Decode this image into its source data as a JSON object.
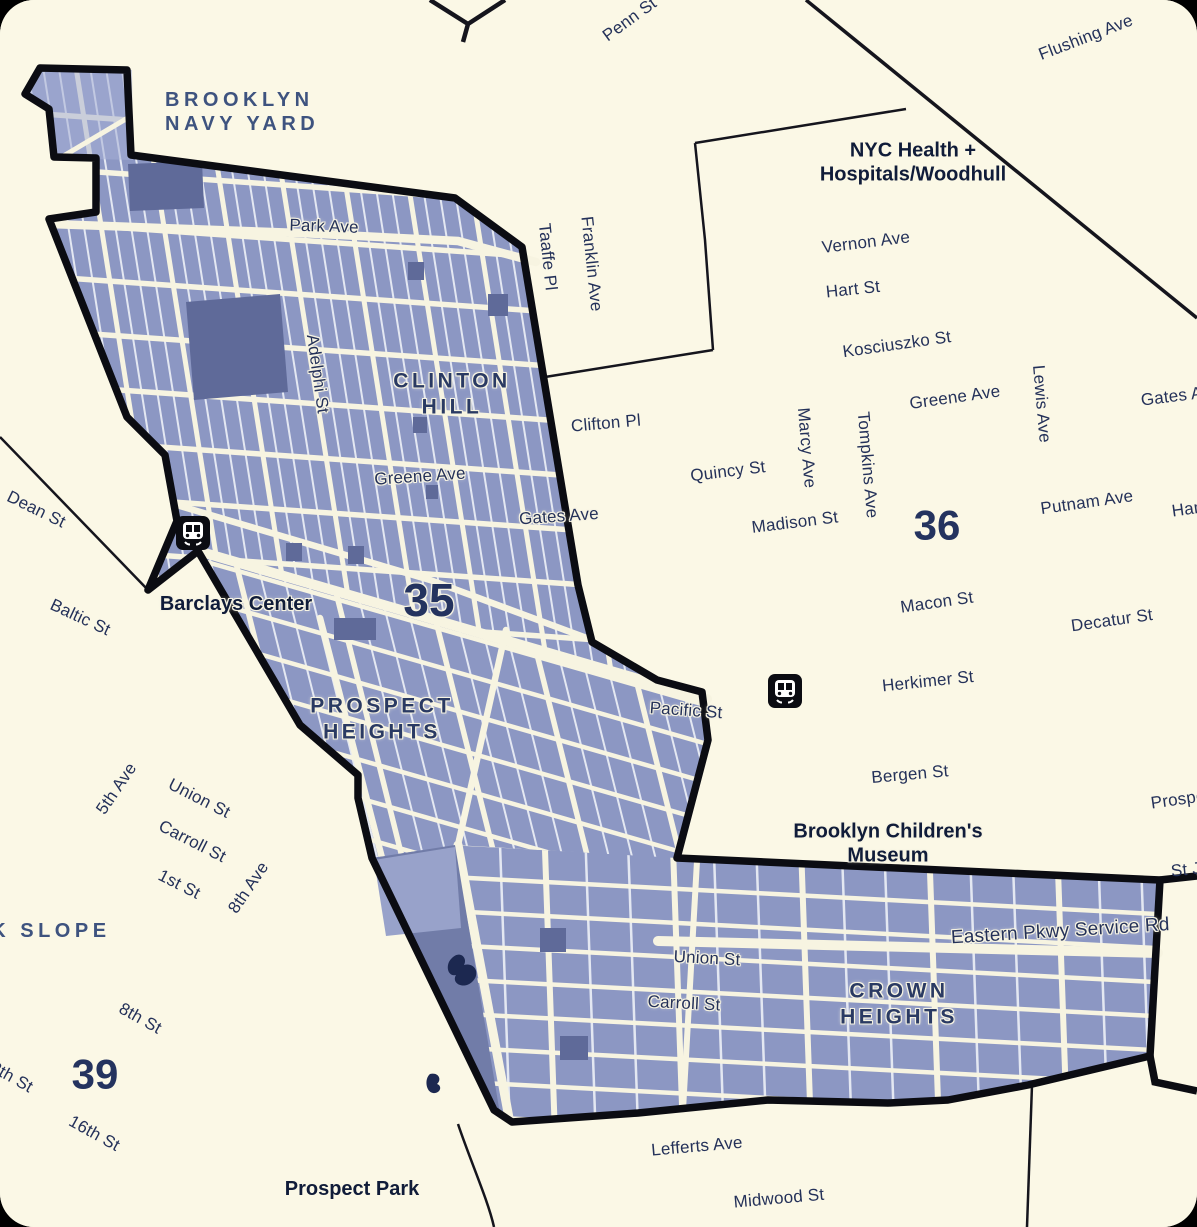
{
  "map": {
    "district_numbers": {
      "d35": "35",
      "d36": "36",
      "d39": "39"
    },
    "neighborhoods": {
      "brooklyn_navy_yard": "BROOKLYN\nNAVY YARD",
      "clinton_hill": "CLINTON\nHILL",
      "prospect_heights": "PROSPECT\nHEIGHTS",
      "crown_heights": "CROWN\nHEIGHTS",
      "park_slope": "PARK SLOPE"
    },
    "places": {
      "woodhull": "NYC Health +\nHospitals/Woodhull",
      "barclays_center": "Barclays Center",
      "brooklyn_childrens_museum": "Brooklyn Children's\nMuseum",
      "prospect_park": "Prospect Park"
    },
    "streets_outside": {
      "penn_st": "Penn St",
      "flushing_ave": "Flushing Ave",
      "vernon_ave": "Vernon Ave",
      "hart_st": "Hart St",
      "kosciuszko_st": "Kosciuszko St",
      "greene_ave_east": "Greene Ave",
      "lewis_ave": "Lewis Ave",
      "tompkins_ave": "Tompkins Ave",
      "marcy_ave": "Marcy Ave",
      "quincy_st": "Quincy St",
      "madison_st": "Madison St",
      "gates_ave_east": "Gates Ave",
      "hancock_st": "Hancock St",
      "putnam_ave": "Putnam Ave",
      "macon_st": "Macon St",
      "decatur_st": "Decatur St",
      "herkimer_st": "Herkimer St",
      "bergen_st": "Bergen St",
      "prospect_pl": "Prospect Pl",
      "st_johns_pl": "St Johns Pl",
      "dean_st": "Dean St",
      "baltic_st": "Baltic St",
      "fifth_ave": "5th Ave",
      "union_st_west": "Union St",
      "carroll_st_west": "Carroll St",
      "first_st": "1st St",
      "eighth_ave": "8th Ave",
      "eighth_st": "8th St",
      "thirteenth_st": "13th St",
      "sixteenth_st": "16th St",
      "lefferts_ave": "Lefferts Ave",
      "midwood_st": "Midwood St",
      "taaffe_pl": "Taaffe Pl",
      "franklin_ave": "Franklin Ave",
      "clifton_pl": "Clifton Pl"
    },
    "streets_inside": {
      "park_ave": "Park Ave",
      "adelphi_st": "Adelphi St",
      "greene_ave": "Greene Ave",
      "gates_ave": "Gates Ave",
      "pacific_st": "Pacific St",
      "union_st": "Union St",
      "carroll_st": "Carroll St",
      "eastern_pkwy_service_rd": "Eastern Pkwy Service Rd"
    },
    "icons": {
      "subway_station_1": "subway-station",
      "subway_station_2": "subway-station"
    },
    "colors": {
      "background": "#FBF8E6",
      "district_fill": "#8C97C3",
      "district_fill_light": "#A6AFD5",
      "park_block": "#5F6A99",
      "garden_triangle": "#717CA8",
      "pond": "#1C2850",
      "street": "#F7F4E1",
      "boundary": "#0B0C12",
      "label_navy": "#243159",
      "label_steel_blue": "#3E537F"
    }
  }
}
